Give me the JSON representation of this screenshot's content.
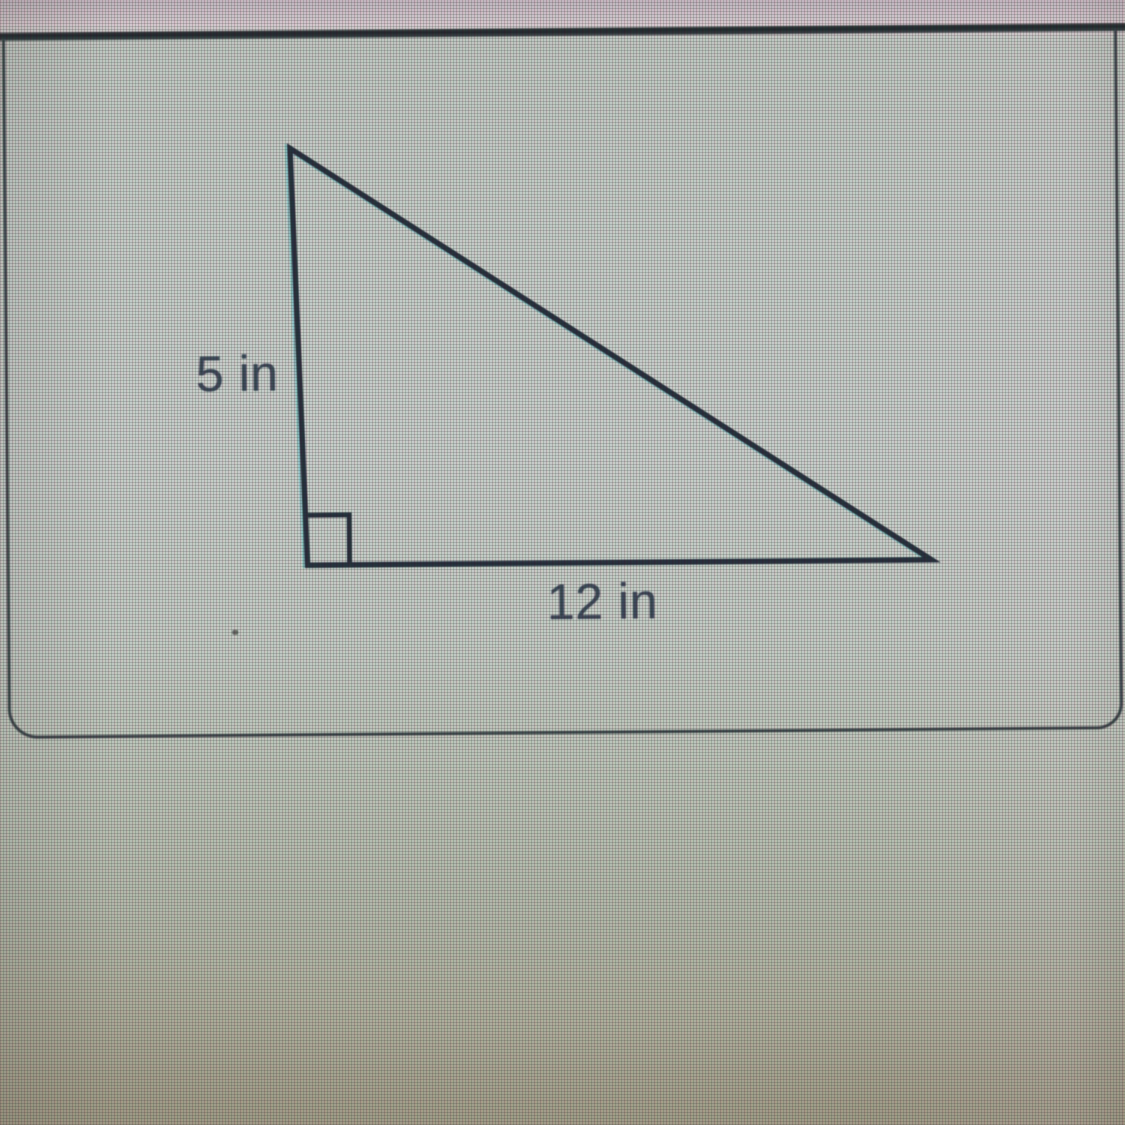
{
  "figure": {
    "type": "right-triangle-diagram",
    "labels": {
      "vertical_leg": "5 in",
      "horizontal_leg": "12 in"
    },
    "right_angle_marker": true,
    "geometry": {
      "apex": [
        288,
        120
      ],
      "right_angle_vertex": [
        302,
        537
      ],
      "right_vertex": [
        926,
        537
      ],
      "marker_w": 42,
      "marker_h": 50
    }
  },
  "colors": {
    "triangle_stroke": "#1c2431",
    "label_text": "#353f4e",
    "card_border": "#30373b",
    "top_divider": "#141a1e",
    "screen_top_band": "#dbccd0",
    "screen_body": "#cacfc8",
    "screen_bottom": "#a69f87"
  }
}
